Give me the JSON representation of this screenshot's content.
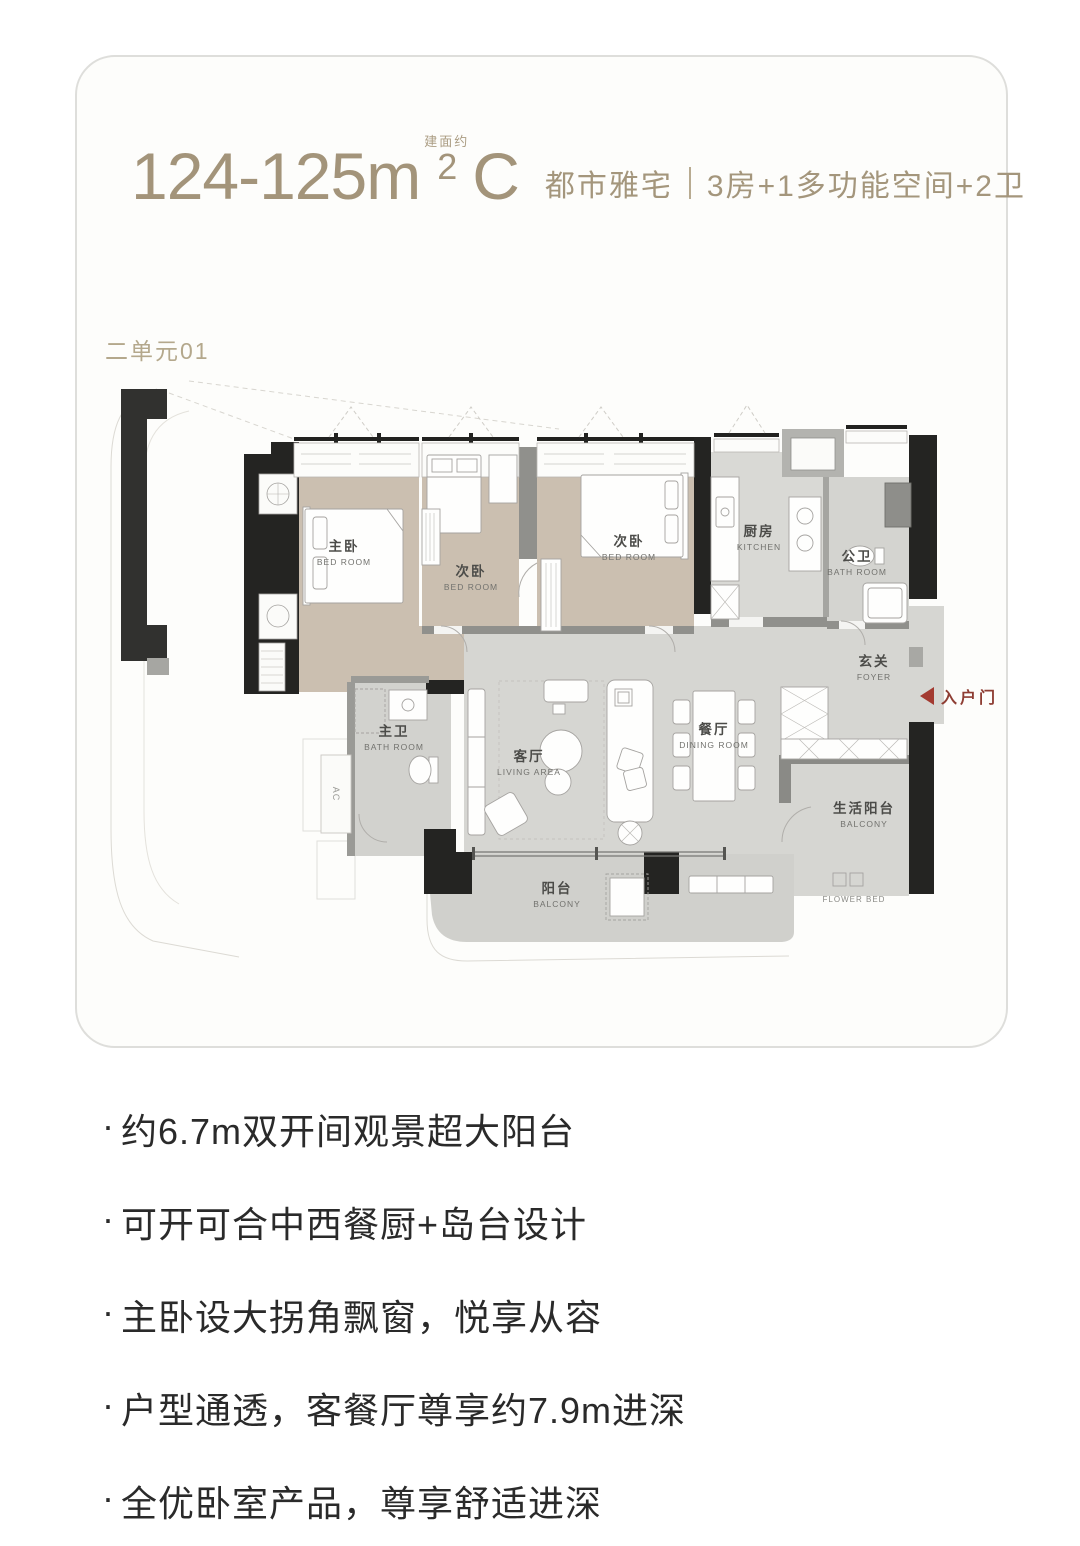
{
  "header": {
    "area": "124-125m",
    "area_note": "建面约",
    "area_sup": "2",
    "unit_type": "C",
    "tagline": "都市雅宅",
    "spec": "3房+1多功能空间+2卫"
  },
  "plan": {
    "unit_label": "二单元01",
    "entry_label": "入户门",
    "ac_label": "AC",
    "flower_bed_label": "FLOWER BED",
    "rooms": {
      "master_bedroom": {
        "cn": "主卧",
        "en": "BED ROOM"
      },
      "bedroom2": {
        "cn": "次卧",
        "en": "BED ROOM"
      },
      "bedroom3": {
        "cn": "次卧",
        "en": "BED ROOM"
      },
      "kitchen": {
        "cn": "厨房",
        "en": "KITCHEN"
      },
      "public_bath": {
        "cn": "公卫",
        "en": "BATH ROOM"
      },
      "foyer": {
        "cn": "玄关",
        "en": "FOYER"
      },
      "master_bath": {
        "cn": "主卫",
        "en": "BATH ROOM"
      },
      "living": {
        "cn": "客厅",
        "en": "LIVING AREA"
      },
      "dining": {
        "cn": "餐厅",
        "en": "DINING ROOM"
      },
      "balcony": {
        "cn": "阳台",
        "en": "BALCONY"
      },
      "life_balcony": {
        "cn": "生活阳台",
        "en": "BALCONY"
      }
    }
  },
  "features": {
    "bullet": "·",
    "items": [
      "约6.7m双开间观景超大阳台",
      "可开可合中西餐厨+岛台设计",
      "主卧设大拐角飘窗，悦享从容",
      "户型通透，客餐厅尊享约7.9m进深",
      "全优卧室产品，尊享舒适进深",
      "多功能+1空间灵活多变"
    ]
  },
  "colors": {
    "accent_gold": "#a3947a",
    "entry_red": "#a33a30",
    "floor_tan": "#cbbfb0",
    "floor_gray": "#d6d6d2",
    "wall_black": "#242422",
    "wall_gray": "#90908c"
  }
}
